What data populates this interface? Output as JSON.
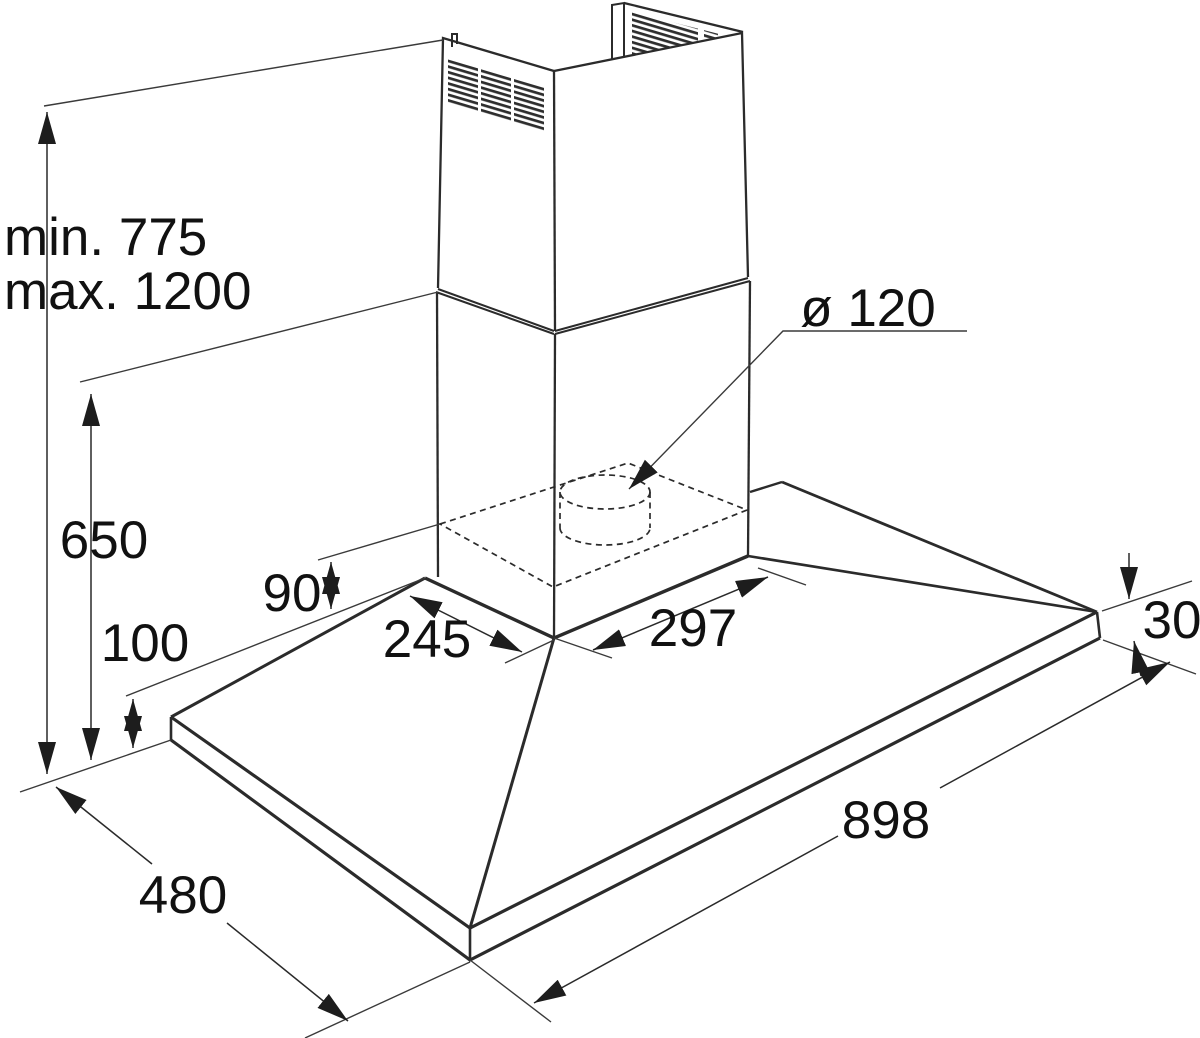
{
  "diagram": {
    "type": "installation-dimension-drawing",
    "subject": "chimney cooker hood",
    "unit": "mm",
    "colors": {
      "line": "#2b2b2b",
      "text": "#111111",
      "background": "#ffffff"
    },
    "dimensions": {
      "min_height": "min. 775",
      "max_height": "max. 1200",
      "chimney_section_height": "650",
      "rear_bottom_offset": "100",
      "body_height": "90",
      "body_depth": "245",
      "body_width": "297",
      "duct_diameter": "ø 120",
      "canopy_rim_thickness": "30",
      "canopy_width": "898",
      "canopy_depth": "480"
    }
  }
}
